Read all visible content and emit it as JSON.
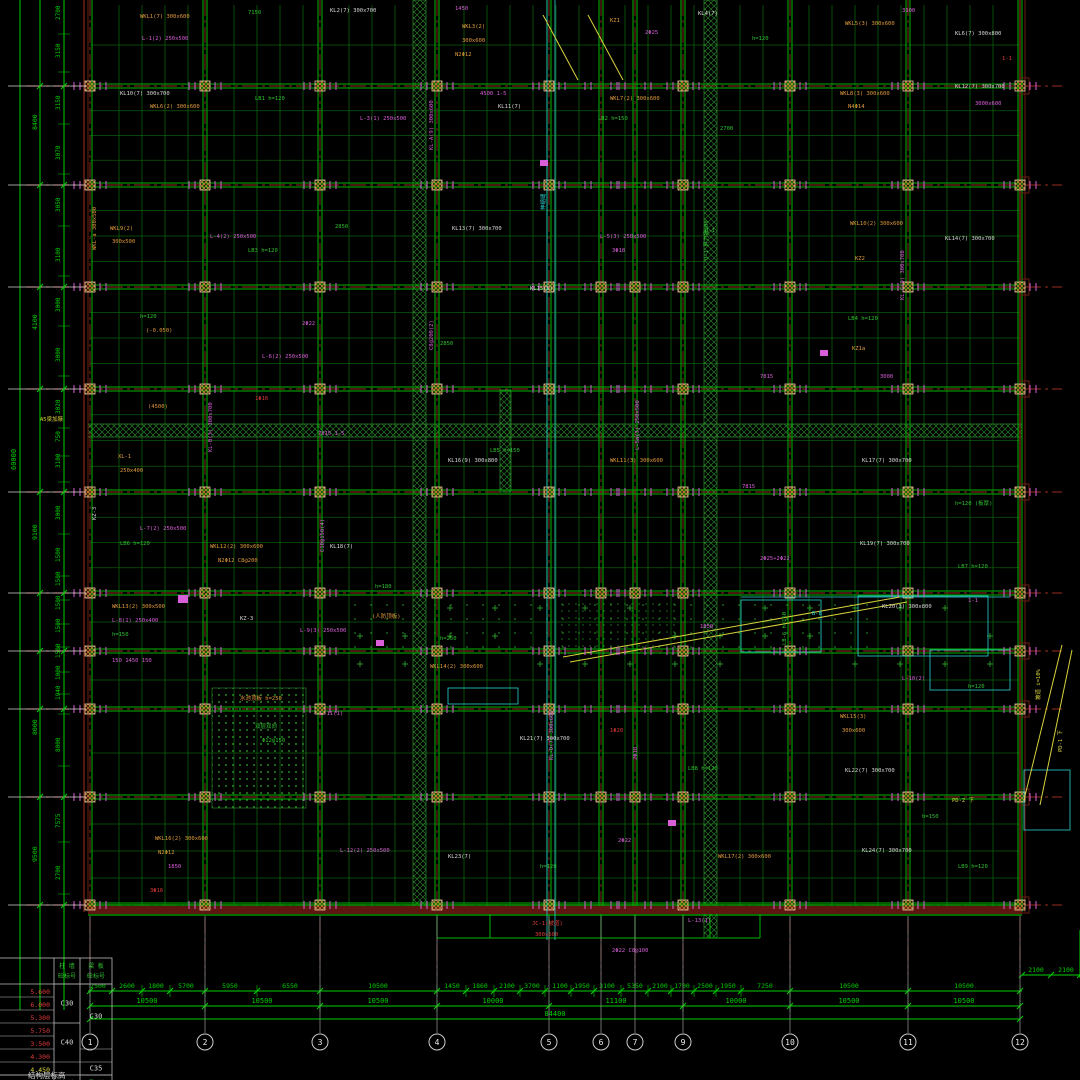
{
  "drawing": {
    "title_note": "结构层标高",
    "total_bottom": "84400",
    "total_left": "60000",
    "extra_right_dims": [
      "2100",
      "2100"
    ]
  },
  "colors": {
    "beam_green": "#00b400",
    "joist_green": "#0d720d",
    "dim_green": "#00d000",
    "grid_red": "#7e241a",
    "edge_brown": "#6e2014",
    "magenta": "#d95fd9",
    "cyan": "#2ad4d4",
    "orange": "#e09a3c",
    "white": "#d8d8d8",
    "red_text": "#e03c3c",
    "yellow": "#d8d23c",
    "hatch": "#2f8f2f"
  },
  "grid": {
    "cols": [
      {
        "label": "1",
        "x": 90
      },
      {
        "label": "2",
        "x": 205
      },
      {
        "label": "3",
        "x": 320
      },
      {
        "label": "4",
        "x": 437
      },
      {
        "label": "5",
        "x": 549
      },
      {
        "label": "6",
        "x": 601
      },
      {
        "label": "7",
        "x": 635
      },
      {
        "label": "9",
        "x": 683
      },
      {
        "label": "10",
        "x": 790
      },
      {
        "label": "11",
        "x": 908
      },
      {
        "label": "12",
        "x": 1020
      }
    ],
    "rows": [
      86,
      185,
      287,
      389,
      492,
      593,
      651,
      709,
      797,
      905
    ]
  },
  "dimensions": {
    "bottom": {
      "tier1": [
        {
          "x": 98,
          "v": "2500"
        },
        {
          "x": 127,
          "v": "2600"
        },
        {
          "x": 156,
          "v": "1800"
        },
        {
          "x": 186,
          "v": "5700"
        },
        {
          "x": 230,
          "v": "5950"
        },
        {
          "x": 290,
          "v": "6550"
        },
        {
          "x": 378,
          "v": "10500"
        },
        {
          "x": 452,
          "v": "1450"
        },
        {
          "x": 480,
          "v": "1860"
        },
        {
          "x": 507,
          "v": "2100"
        },
        {
          "x": 532,
          "v": "3700"
        },
        {
          "x": 560,
          "v": "1100"
        },
        {
          "x": 582,
          "v": "1950"
        },
        {
          "x": 607,
          "v": "3100"
        },
        {
          "x": 635,
          "v": "5350"
        },
        {
          "x": 660,
          "v": "2100"
        },
        {
          "x": 682,
          "v": "1700"
        },
        {
          "x": 705,
          "v": "2500"
        },
        {
          "x": 728,
          "v": "1950"
        },
        {
          "x": 765,
          "v": "7250"
        },
        {
          "x": 849,
          "v": "10500"
        },
        {
          "x": 964,
          "v": "10500"
        }
      ],
      "tier1_ticks": [
        90,
        112,
        142,
        170,
        205,
        257,
        320,
        437,
        466,
        494,
        520,
        545,
        571,
        594,
        621,
        648,
        671,
        694,
        716,
        741,
        790,
        908,
        1020
      ],
      "tier2": [
        {
          "x": 147,
          "v": "10500"
        },
        {
          "x": 262,
          "v": "10500"
        },
        {
          "x": 378,
          "v": "10500"
        },
        {
          "x": 493,
          "v": "10000"
        },
        {
          "x": 616,
          "v": "11100"
        },
        {
          "x": 736,
          "v": "10000"
        },
        {
          "x": 849,
          "v": "10500"
        },
        {
          "x": 964,
          "v": "10500"
        }
      ],
      "tier2_ticks": [
        90,
        205,
        320,
        437,
        549,
        683,
        790,
        908,
        1020
      ]
    },
    "left": {
      "inner": [
        {
          "y": 20,
          "v": "2700"
        },
        {
          "y": 58,
          "v": "3150"
        },
        {
          "y": 110,
          "v": "3150"
        },
        {
          "y": 160,
          "v": "3070"
        },
        {
          "y": 212,
          "v": "3050"
        },
        {
          "y": 262,
          "v": "3100"
        },
        {
          "y": 312,
          "v": "3000"
        },
        {
          "y": 362,
          "v": "3000"
        },
        {
          "y": 414,
          "v": "3020"
        },
        {
          "y": 442,
          "v": "750"
        },
        {
          "y": 468,
          "v": "3100"
        },
        {
          "y": 520,
          "v": "3000"
        },
        {
          "y": 562,
          "v": "1500"
        },
        {
          "y": 586,
          "v": "1500"
        },
        {
          "y": 610,
          "v": "1500"
        },
        {
          "y": 633,
          "v": "1500"
        },
        {
          "y": 658,
          "v": "1500"
        },
        {
          "y": 680,
          "v": "1000"
        },
        {
          "y": 700,
          "v": "1940"
        },
        {
          "y": 752,
          "v": "8000"
        },
        {
          "y": 828,
          "v": "7575"
        },
        {
          "y": 880,
          "v": "2700"
        }
      ],
      "outer": [
        {
          "y": 130,
          "v": "8400"
        },
        {
          "y": 330,
          "v": "4100"
        },
        {
          "y": 540,
          "v": "9100"
        },
        {
          "y": 735,
          "v": "8000"
        },
        {
          "y": 862,
          "v": "9500"
        }
      ]
    }
  },
  "table": {
    "headers": [
      [
        "柱 墙",
        "砼标号"
      ],
      [
        "梁 板",
        "砼标号"
      ]
    ],
    "elevations": [
      "5.600",
      "6.000",
      "5.300",
      "5.750",
      "3.500",
      "4.300",
      "4.450"
    ],
    "grades_col1": [
      {
        "v": "C30",
        "row": 0,
        "span": 3
      },
      {
        "v": "C40",
        "row": 3,
        "span": 3
      }
    ],
    "grades_col2": [
      {
        "v": "C30",
        "row": 0,
        "span": 5
      },
      {
        "v": "C35",
        "row": 6,
        "span": 1
      }
    ],
    "footer": [
      "层高(m)",
      "柱 墙",
      "梁 板"
    ],
    "note": "结构层标高"
  },
  "ramps": [
    {
      "text": "坡道 i=10%"
    },
    {
      "text": "PD-1 下"
    }
  ],
  "annotations": [
    {
      "x": 140,
      "y": 18,
      "t": "WKL1(7) 300x600",
      "c": "o"
    },
    {
      "x": 142,
      "y": 40,
      "t": "L-1(2) 250x500",
      "c": "m"
    },
    {
      "x": 248,
      "y": 14,
      "t": "7150",
      "c": "g"
    },
    {
      "x": 330,
      "y": 12,
      "t": "KL2(7) 300x700",
      "c": "w"
    },
    {
      "x": 455,
      "y": 10,
      "t": "1450",
      "c": "m"
    },
    {
      "x": 462,
      "y": 28,
      "t": "WKL3(2)",
      "c": "o"
    },
    {
      "x": 462,
      "y": 42,
      "t": "300x600",
      "c": "o"
    },
    {
      "x": 455,
      "y": 56,
      "t": "N2Φ12",
      "c": "o"
    },
    {
      "x": 610,
      "y": 22,
      "t": "KZ1",
      "c": "o"
    },
    {
      "x": 645,
      "y": 34,
      "t": "2Φ25",
      "c": "m"
    },
    {
      "x": 698,
      "y": 15,
      "t": "KL4(7)",
      "c": "w"
    },
    {
      "x": 752,
      "y": 40,
      "t": "h=120",
      "c": "g"
    },
    {
      "x": 845,
      "y": 25,
      "t": "WKL5(3) 300x600",
      "c": "o"
    },
    {
      "x": 902,
      "y": 12,
      "t": "3100",
      "c": "m"
    },
    {
      "x": 955,
      "y": 35,
      "t": "KL6(7) 300x800",
      "c": "w"
    },
    {
      "x": 1002,
      "y": 60,
      "t": "1-1",
      "c": "r"
    },
    {
      "x": 120,
      "y": 95,
      "t": "KL10(7) 300x700",
      "c": "w"
    },
    {
      "x": 150,
      "y": 108,
      "t": "WKL6(2) 300x600",
      "c": "o"
    },
    {
      "x": 255,
      "y": 100,
      "t": "LB1 h=120",
      "c": "g"
    },
    {
      "x": 360,
      "y": 120,
      "t": "L-3(1) 250x500",
      "c": "m"
    },
    {
      "x": 480,
      "y": 95,
      "t": "4500 1-5",
      "c": "m"
    },
    {
      "x": 498,
      "y": 108,
      "t": "KL11(7)",
      "c": "w"
    },
    {
      "x": 610,
      "y": 100,
      "t": "WKL7(2) 300x600",
      "c": "o"
    },
    {
      "x": 598,
      "y": 120,
      "t": "LB2 h=150",
      "c": "g"
    },
    {
      "x": 720,
      "y": 130,
      "t": "2700",
      "c": "g"
    },
    {
      "x": 840,
      "y": 95,
      "t": "WKL8(3) 300x600",
      "c": "o"
    },
    {
      "x": 848,
      "y": 108,
      "t": "N4Φ14",
      "c": "o"
    },
    {
      "x": 955,
      "y": 88,
      "t": "KL12(7) 300x700",
      "c": "w"
    },
    {
      "x": 975,
      "y": 105,
      "t": "3000x600",
      "c": "m"
    },
    {
      "x": 110,
      "y": 230,
      "t": "WKL9(2)",
      "c": "o"
    },
    {
      "x": 112,
      "y": 243,
      "t": "300x500",
      "c": "o"
    },
    {
      "x": 210,
      "y": 238,
      "t": "L-4(2) 250x500",
      "c": "m"
    },
    {
      "x": 248,
      "y": 252,
      "t": "LB3 h=120",
      "c": "g"
    },
    {
      "x": 335,
      "y": 228,
      "t": "2850",
      "c": "g"
    },
    {
      "x": 452,
      "y": 230,
      "t": "KL13(7) 300x700",
      "c": "w"
    },
    {
      "x": 600,
      "y": 238,
      "t": "L-5(3) 250x500",
      "c": "m"
    },
    {
      "x": 612,
      "y": 252,
      "t": "3Φ18",
      "c": "m"
    },
    {
      "x": 705,
      "y": 232,
      "t": "Q-1",
      "c": "g"
    },
    {
      "x": 850,
      "y": 225,
      "t": "WKL10(2) 300x600",
      "c": "o"
    },
    {
      "x": 855,
      "y": 260,
      "t": "KZ2",
      "c": "o"
    },
    {
      "x": 945,
      "y": 240,
      "t": "KL14(7) 300x700",
      "c": "w"
    },
    {
      "x": 140,
      "y": 318,
      "t": "h=120",
      "c": "g"
    },
    {
      "x": 146,
      "y": 332,
      "t": "(-0.050)",
      "c": "o"
    },
    {
      "x": 302,
      "y": 325,
      "t": "2Φ22",
      "c": "m"
    },
    {
      "x": 262,
      "y": 358,
      "t": "L-6(2) 250x500",
      "c": "m"
    },
    {
      "x": 440,
      "y": 345,
      "t": "2850",
      "c": "g"
    },
    {
      "x": 530,
      "y": 290,
      "t": "KL15(9)",
      "c": "w"
    },
    {
      "x": 760,
      "y": 378,
      "t": "7815",
      "c": "m"
    },
    {
      "x": 848,
      "y": 320,
      "t": "LB4 h=120",
      "c": "g"
    },
    {
      "x": 852,
      "y": 350,
      "t": "KZ1a",
      "c": "o"
    },
    {
      "x": 880,
      "y": 378,
      "t": "3000",
      "c": "m"
    },
    {
      "x": 40,
      "y": 421,
      "t": "A5梁加腋",
      "c": "y"
    },
    {
      "x": 148,
      "y": 408,
      "t": "(4500)",
      "c": "o"
    },
    {
      "x": 255,
      "y": 400,
      "t": "1Φ16",
      "c": "r"
    },
    {
      "x": 318,
      "y": 435,
      "t": "7815 1-5",
      "c": "m"
    },
    {
      "x": 448,
      "y": 462,
      "t": "KL16(9) 300x800",
      "c": "w"
    },
    {
      "x": 490,
      "y": 452,
      "t": "LB5 h=150",
      "c": "g"
    },
    {
      "x": 610,
      "y": 462,
      "t": "WKL11(3) 300x600",
      "c": "o"
    },
    {
      "x": 742,
      "y": 488,
      "t": "7815",
      "c": "m"
    },
    {
      "x": 862,
      "y": 462,
      "t": "KL17(7) 300x700",
      "c": "w"
    },
    {
      "x": 955,
      "y": 505,
      "t": "h=120 (板厚)",
      "c": "g"
    },
    {
      "x": 118,
      "y": 458,
      "t": "XL-1",
      "c": "o"
    },
    {
      "x": 120,
      "y": 472,
      "t": "250x400",
      "c": "o"
    },
    {
      "x": 140,
      "y": 530,
      "t": "L-7(2) 250x500",
      "c": "m"
    },
    {
      "x": 120,
      "y": 545,
      "t": "LB6 h=120",
      "c": "g"
    },
    {
      "x": 210,
      "y": 548,
      "t": "WKL12(2) 300x600",
      "c": "o"
    },
    {
      "x": 218,
      "y": 562,
      "t": "N2Φ12 C8@200",
      "c": "o"
    },
    {
      "x": 330,
      "y": 548,
      "t": "KL18(7)",
      "c": "w"
    },
    {
      "x": 375,
      "y": 588,
      "t": "h=180",
      "c": "g"
    },
    {
      "x": 760,
      "y": 560,
      "t": "2Φ25+2Φ22",
      "c": "m"
    },
    {
      "x": 860,
      "y": 545,
      "t": "KL19(7) 300x700",
      "c": "w"
    },
    {
      "x": 958,
      "y": 568,
      "t": "LB7 h=120",
      "c": "g"
    },
    {
      "x": 112,
      "y": 608,
      "t": "WKL13(2) 300x500",
      "c": "o"
    },
    {
      "x": 112,
      "y": 622,
      "t": "L-8(1) 250x400",
      "c": "m"
    },
    {
      "x": 112,
      "y": 636,
      "t": "h=150",
      "c": "g"
    },
    {
      "x": 240,
      "y": 620,
      "t": "KZ-3",
      "c": "w"
    },
    {
      "x": 300,
      "y": 632,
      "t": "L-9(3) 250x500",
      "c": "m"
    },
    {
      "x": 372,
      "y": 618,
      "t": "(人防顶板)",
      "c": "o"
    },
    {
      "x": 440,
      "y": 640,
      "t": "h=250",
      "c": "g"
    },
    {
      "x": 700,
      "y": 628,
      "t": "1850",
      "c": "m"
    },
    {
      "x": 812,
      "y": 615,
      "t": "B-B",
      "c": "c"
    },
    {
      "x": 882,
      "y": 608,
      "t": "KL20(3) 300x800",
      "c": "w"
    },
    {
      "x": 968,
      "y": 602,
      "t": "1-1",
      "c": "m"
    },
    {
      "x": 112,
      "y": 662,
      "t": "150 1450 150",
      "c": "m"
    },
    {
      "x": 430,
      "y": 668,
      "t": "WKL14(2) 300x600",
      "c": "o"
    },
    {
      "x": 902,
      "y": 680,
      "t": "L-10(2)",
      "c": "m"
    },
    {
      "x": 968,
      "y": 688,
      "t": "h=120",
      "c": "g"
    },
    {
      "x": 240,
      "y": 700,
      "t": "水池顶板 h=250",
      "c": "o"
    },
    {
      "x": 255,
      "y": 728,
      "t": "双层双向",
      "c": "g"
    },
    {
      "x": 262,
      "y": 742,
      "t": "Φ12@150",
      "c": "g"
    },
    {
      "x": 320,
      "y": 715,
      "t": "L-11(1)",
      "c": "m"
    },
    {
      "x": 520,
      "y": 740,
      "t": "KL21(7) 300x700",
      "c": "w"
    },
    {
      "x": 610,
      "y": 732,
      "t": "1Φ20",
      "c": "r"
    },
    {
      "x": 688,
      "y": 770,
      "t": "LB8 h=120",
      "c": "g"
    },
    {
      "x": 840,
      "y": 718,
      "t": "WKL15(3)",
      "c": "o"
    },
    {
      "x": 842,
      "y": 732,
      "t": "300x600",
      "c": "o"
    },
    {
      "x": 845,
      "y": 772,
      "t": "KL22(7) 300x700",
      "c": "w"
    },
    {
      "x": 952,
      "y": 802,
      "t": "PD-2 下",
      "c": "y"
    },
    {
      "x": 922,
      "y": 818,
      "t": "h=150",
      "c": "g"
    },
    {
      "x": 155,
      "y": 840,
      "t": "WKL16(2) 300x600",
      "c": "o"
    },
    {
      "x": 158,
      "y": 854,
      "t": "N2Φ12",
      "c": "o"
    },
    {
      "x": 168,
      "y": 868,
      "t": "1850",
      "c": "m"
    },
    {
      "x": 340,
      "y": 852,
      "t": "L-12(2) 250x500",
      "c": "m"
    },
    {
      "x": 448,
      "y": 858,
      "t": "KL23(7)",
      "c": "w"
    },
    {
      "x": 540,
      "y": 868,
      "t": "h=120",
      "c": "g"
    },
    {
      "x": 618,
      "y": 842,
      "t": "2Φ22",
      "c": "m"
    },
    {
      "x": 718,
      "y": 858,
      "t": "WKL17(2) 300x600",
      "c": "o"
    },
    {
      "x": 862,
      "y": 852,
      "t": "KL24(7) 300x700",
      "c": "w"
    },
    {
      "x": 958,
      "y": 868,
      "t": "LB9 h=120",
      "c": "g"
    },
    {
      "x": 150,
      "y": 892,
      "t": "3Φ16",
      "c": "r"
    },
    {
      "x": 532,
      "y": 925,
      "t": "JC-1(坡道)",
      "c": "r"
    },
    {
      "x": 535,
      "y": 936,
      "t": "300x600",
      "c": "r"
    },
    {
      "x": 612,
      "y": 952,
      "t": "2Φ22 C8@100",
      "c": "m"
    },
    {
      "x": 688,
      "y": 922,
      "t": "L-13(1)",
      "c": "m"
    }
  ],
  "vannotations": [
    {
      "x": 433,
      "y": 150,
      "t": "KL-A(9) 300x600",
      "c": "m"
    },
    {
      "x": 433,
      "y": 350,
      "t": "C8@200(2)",
      "c": "m"
    },
    {
      "x": 545,
      "y": 210,
      "t": "伸缩缝",
      "c": "c"
    },
    {
      "x": 708,
      "y": 260,
      "t": "Q-1 剪力墙300",
      "c": "g"
    },
    {
      "x": 212,
      "y": 452,
      "t": "KL-B(3) 300x700",
      "c": "m"
    },
    {
      "x": 904,
      "y": 300,
      "t": "KL-C(9) 300x700",
      "c": "m"
    },
    {
      "x": 639,
      "y": 450,
      "t": "L-5a(3) 250x500",
      "c": "m"
    },
    {
      "x": 324,
      "y": 552,
      "t": "C10@150(4)",
      "c": "m"
    },
    {
      "x": 96,
      "y": 520,
      "t": "KZ-3",
      "c": "w"
    },
    {
      "x": 786,
      "y": 645,
      "t": "LB-6 h=150",
      "c": "g"
    },
    {
      "x": 553,
      "y": 760,
      "t": "KL-D(7) 300x600",
      "c": "m"
    },
    {
      "x": 96,
      "y": 250,
      "t": "WKL-a 300x500",
      "c": "o"
    },
    {
      "x": 1040,
      "y": 700,
      "t": "坡道 i=10%",
      "c": "y"
    },
    {
      "x": 1062,
      "y": 752,
      "t": "PD-1 下",
      "c": "y"
    },
    {
      "x": 637,
      "y": 760,
      "t": "2Φ18",
      "c": "m"
    }
  ]
}
